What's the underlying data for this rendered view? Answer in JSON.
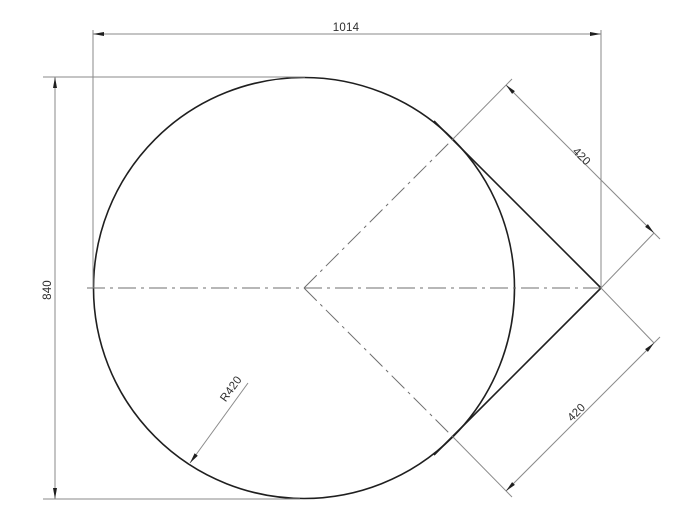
{
  "drawing": {
    "type": "technical-dimension-drawing",
    "labels": {
      "overall_width": "1014",
      "overall_height": "840",
      "upper_tangent_length": "420",
      "lower_tangent_length": "420",
      "radius": "R420"
    },
    "colors": {
      "background": "#ffffff",
      "object_line": "#1f1f1f",
      "dimension_line": "#8a8a8a",
      "centerline": "#6f6f6f",
      "arrow": "#1f1f1f",
      "text": "#2e2e2e"
    }
  }
}
